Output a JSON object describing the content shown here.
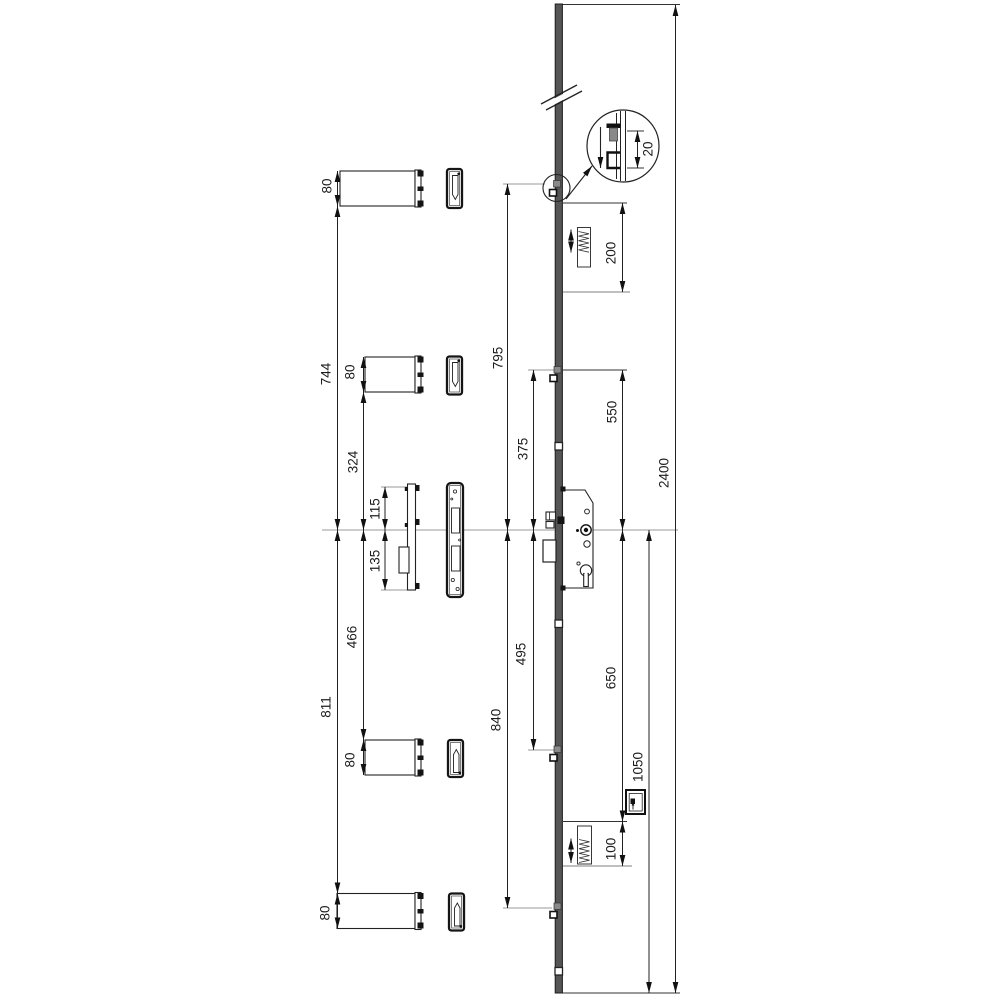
{
  "drawing": {
    "dims": {
      "keep1_height": "80",
      "keep2_height": "80",
      "keep4_height": "80",
      "keep5_height": "80",
      "top_keep_to_center": "744",
      "upper_keep_to_center": "324",
      "faceplate_above_center": "115",
      "faceplate_below_center": "135",
      "lower_keep_to_center": "466",
      "bottom_keep_to_center": "811",
      "top_cam_to_center": "795",
      "upper_hook_to_center": "375",
      "lower_hook_to_center": "495",
      "bottom_cam_to_center": "840",
      "top_unit_length": "200",
      "upper_rod": "550",
      "lower_rod": "650",
      "bottom_unit_length": "100",
      "center_to_bottom_end": "1050",
      "total_length": "2400",
      "detail_throw": "20"
    }
  }
}
